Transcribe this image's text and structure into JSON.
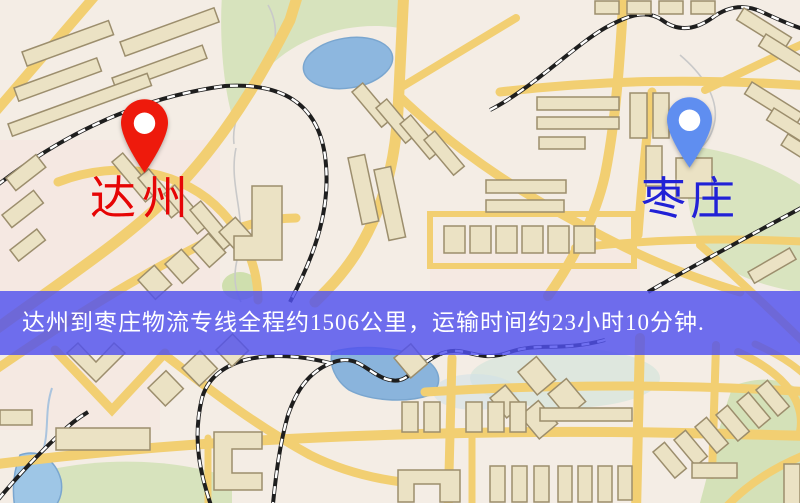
{
  "banner": {
    "text": "达州到枣庄物流专线全程约1506公里，运输时间约23小时10分钟.",
    "bg_color": "rgba(80,80,238,0.82)",
    "text_color": "#ffffff"
  },
  "markers": [
    {
      "id": "a",
      "label": "达州",
      "label_color": "#e60505",
      "pin_color": "#ee1a0c"
    },
    {
      "id": "b",
      "label": "枣庄",
      "label_color": "#2121d6",
      "pin_color": "#5f8ef0"
    }
  ],
  "map_colors": {
    "background": "#f4ede5",
    "road": "#f2cf72",
    "building_fill": "#ebe2c4",
    "building_stroke": "#9c8e6d",
    "park": "#d7e3bd",
    "water": "#8db7df",
    "railway": "#1e1e1e"
  }
}
